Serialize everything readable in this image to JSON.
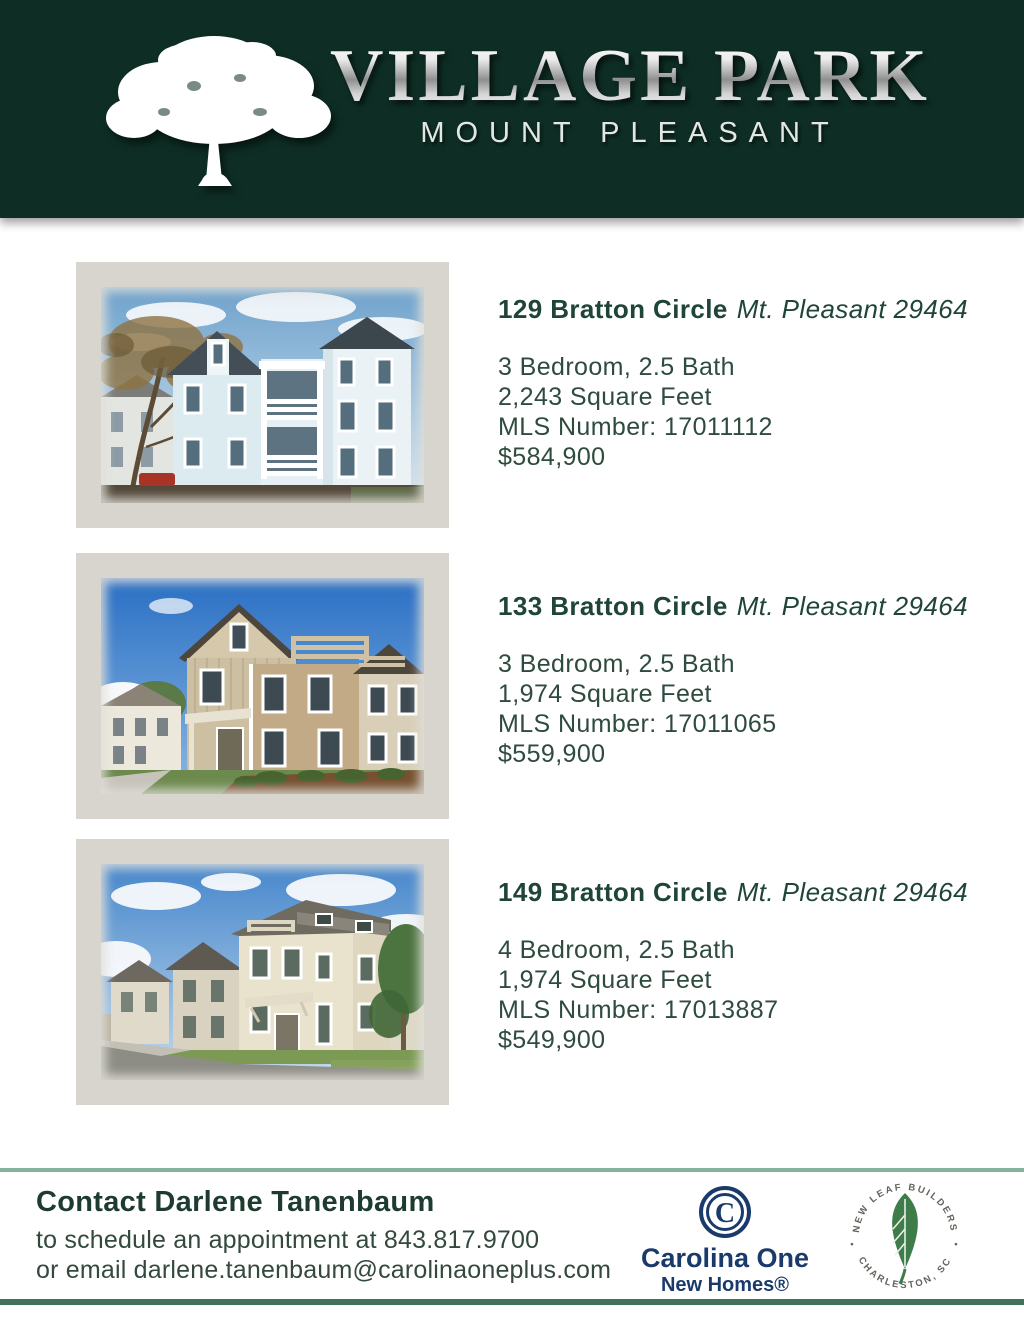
{
  "header": {
    "title": "VILLAGE PARK",
    "subtitle": "MOUNT PLEASANT",
    "logo": "oak-tree-icon"
  },
  "listings": [
    {
      "address": "129 Bratton Circle",
      "location": "Mt. Pleasant 29464",
      "bedbath": "3 Bedroom, 2.5 Bath",
      "sqft": "2,243 Square Feet",
      "mls": "MLS Number: 17011112",
      "price": "$584,900",
      "photo": "three-story white and pale-blue house with stacked double porch, autumn tree at left, red car at curb"
    },
    {
      "address": "133 Bratton Circle",
      "location": "Mt. Pleasant 29464",
      "bedbath": "3 Bedroom, 2.5 Bath",
      "sqft": "1,974 Square Feet",
      "mls": "MLS Number: 17011065",
      "price": "$559,900",
      "photo": "tan two-tone house with rooftop deck railing under bright blue sky with cumulus clouds"
    },
    {
      "address": "149 Bratton Circle",
      "location": "Mt. Pleasant 29464",
      "bedbath": "4 Bedroom, 2.5 Bath",
      "sqft": "1,974 Square Feet",
      "mls": "MLS Number: 17013887",
      "price": "$549,900",
      "photo": "cream corner house on street with neighboring homes receding left and trees at right"
    }
  ],
  "footer": {
    "contact_heading": "Contact Darlene Tanenbaum",
    "contact_line1": "to schedule an appointment at 843.817.9700",
    "contact_line2": "or email darlene.tanenbaum@carolinaoneplus.com",
    "carolina_one": {
      "mark": "C",
      "name": "Carolina One",
      "subname": "New Homes®"
    },
    "new_leaf": {
      "arc_top": "NEW LEAF BUILDERS",
      "arc_bottom": "CHARLESTON, SC",
      "separator": "•"
    }
  },
  "colors": {
    "header_bg": "#0e2e25",
    "heading_green": "#1e4536",
    "body_green": "#2e4b3e",
    "frame_gray": "#d8d5cf",
    "rule_light": "#87b29d",
    "rule_dark": "#3f7458",
    "carolina_navy": "#1a3a6b",
    "leaf_green": "#3e7c4a"
  }
}
